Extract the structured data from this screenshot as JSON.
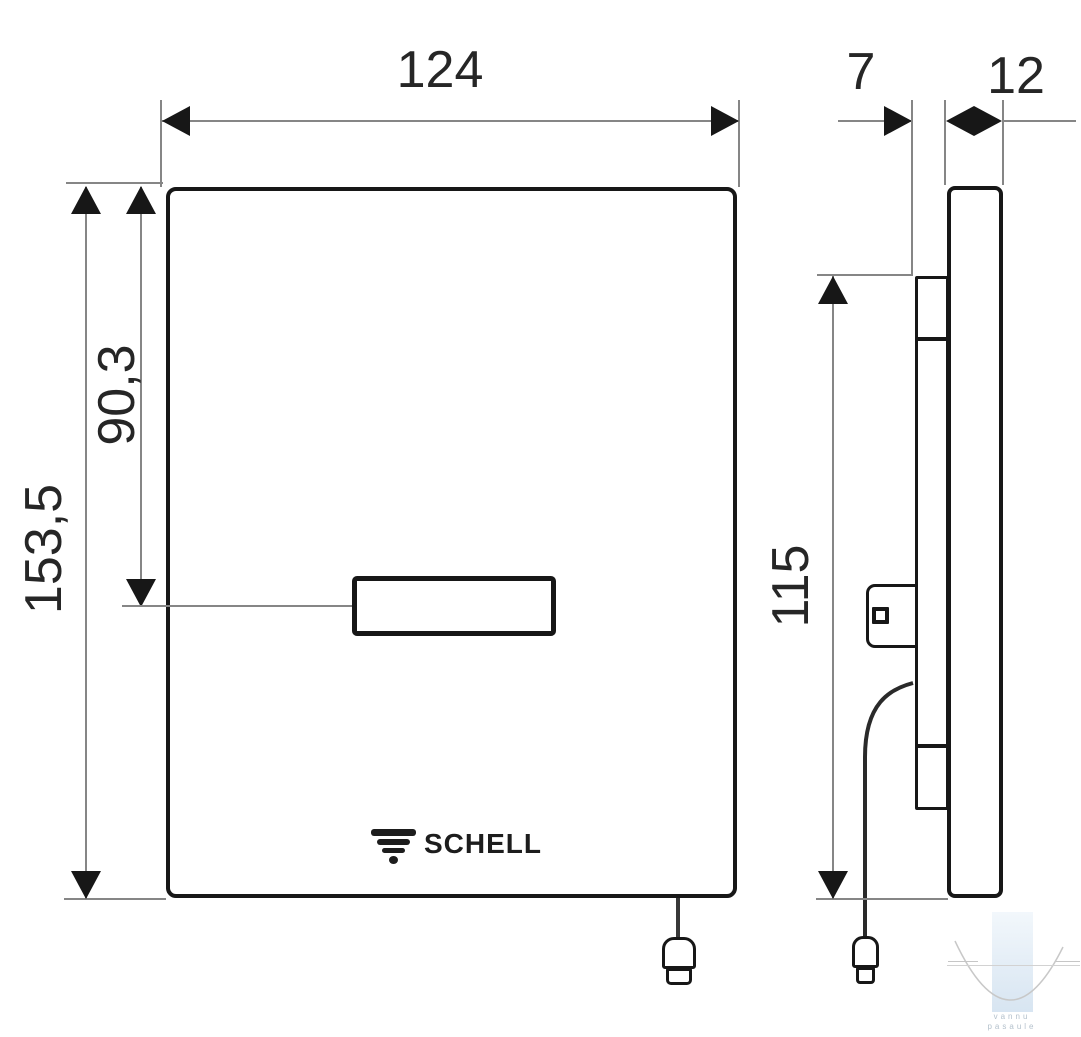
{
  "front_view": {
    "width_label": "124",
    "height_label": "153,5",
    "sensor_offset_label": "90,3",
    "brand": "SCHELL"
  },
  "side_view": {
    "frame_depth_label": "7",
    "panel_thickness_label": "12",
    "height_label": "115"
  },
  "watermark": {
    "line1": "vannu",
    "line2": "pasaule"
  },
  "colors": {
    "drawing_line": "#171717",
    "dimension_line": "#868686",
    "watermark_band_top": "#f0f6fb",
    "watermark_band_bottom": "#d3e2f0",
    "watermark_text": "#b4c1cc"
  }
}
